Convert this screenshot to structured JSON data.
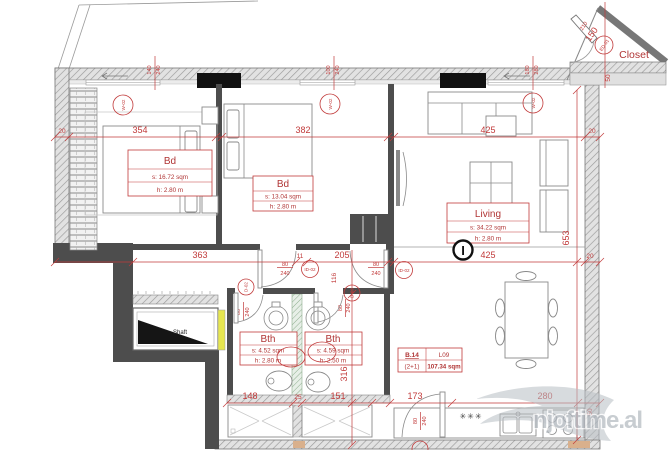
{
  "watermark": {
    "text": "njoftime.al"
  },
  "rooms": {
    "bd1": {
      "name": "Bd",
      "area": "s: 16.72 sqm",
      "height": "h: 2.80 m"
    },
    "bd2": {
      "name": "Bd",
      "area": "s: 13.04 sqm",
      "height": "h: 2.80 m"
    },
    "living": {
      "name": "Living",
      "area": "s: 34.22 sqm",
      "height": "h: 2.80 m"
    },
    "bth1": {
      "name": "Bth",
      "area": "s: 4.52 sqm",
      "height": "h: 2.80 m"
    },
    "bth2": {
      "name": "Bth",
      "area": "s: 4.59 sqm",
      "height": "h: 2.50 m"
    },
    "closet": {
      "name": "Closet"
    },
    "shaft": {
      "name": "Shaft"
    }
  },
  "unit": {
    "id": "B.14",
    "level": "L09",
    "type": "(2+1)",
    "total_area": "107.34 sqm"
  },
  "dims": {
    "wall_left": "20",
    "bd1_width": "354",
    "bd2_width": "382",
    "living_width": "425",
    "wall_right": "20",
    "hall_width": "363",
    "wall_mid": "11",
    "hall_a": "205",
    "hall_b": "116",
    "tray1": "148",
    "tray_gap": "25",
    "tray2": "151",
    "door_zone": "173",
    "kitchen": "280",
    "corner": "50",
    "height_right": "653",
    "bath_height": "316",
    "closet_diag": "150",
    "closet_angle": "210",
    "closet_wall": "50",
    "win1_w": "140",
    "win1_h": "240",
    "win2_w": "100",
    "win2_h": "240",
    "win3_w": "180",
    "win3_h": "280",
    "door_w": "80",
    "door_h": "240"
  },
  "tags": {
    "window": "W-02",
    "door_interior": "ID-02",
    "door": "D-02",
    "door_entry": "ED-01"
  },
  "symbols": {
    "column": "I",
    "vent": "✳✳✳"
  },
  "colors": {
    "dim_red": "#c13a3a",
    "wall_dark": "#4d4d4d",
    "shaft_yellow": "#e6e64f",
    "watermark_gray": "#aeb5bc"
  }
}
